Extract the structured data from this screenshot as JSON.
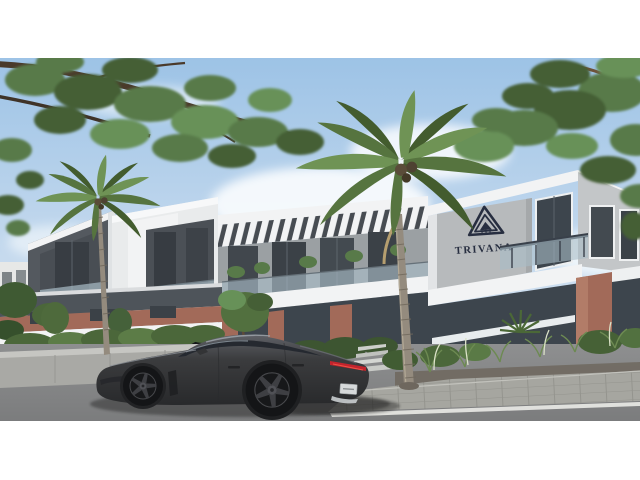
{
  "meta": {
    "kind": "architectural-exterior-render",
    "description": "Modern two-storey TRIVANA mixed-use complex with grey panel upper floor, white fascias, glass balconies and brick ground-floor accents; coconut palms and overhanging branches frame a blue sky; a dark grey fastback sedan passes on the road in the foreground; white letterbox bands top and bottom"
  },
  "branding": {
    "name": "TRIVANA",
    "logo_mark": "nested-triangle-monogram"
  },
  "vehicle": {
    "type": "dark-grey-fastback-sedan",
    "view": "rear-three-quarter-facing-left",
    "tail_light": "full-width-red-bar",
    "license_plate_visible": true
  },
  "palette": {
    "letterbox": "#ffffff",
    "sky_top": "#9dc3e6",
    "sky_mid": "#c6daee",
    "sky_horizon": "#e9f1f7",
    "cloud": "#fbfdfe",
    "panel_dark": "#54595f",
    "panel_darker": "#474c52",
    "fascia": "#f2f3f4",
    "sign_wall": "#b7babc",
    "logo": "#272e40",
    "brick": "#a26a59",
    "glass_dark": "#3d454d",
    "balustrade": "#a9bcc6",
    "awning": "#e8ecee",
    "road": "#8e8f90",
    "road_low": "#7b7c7d",
    "marking": "#e6e6e2",
    "sidewalk": "#a6a6a0",
    "wall_gray": "#a9a9a5",
    "foliage": "#587a49",
    "foliage_dark": "#455f36",
    "foliage_light": "#679158",
    "frond": "#56743f",
    "frond_dark": "#435c2e",
    "frond_light": "#6f9355",
    "trunk": "#948b7e",
    "branch_left": "#4a3a2b",
    "branch_right": "#7c5d41",
    "car_body": "#3b3c3e",
    "car_glass": "#252930",
    "tail_red": "#c3242d",
    "rim": "#3e3f43",
    "plate": "#d6d9da",
    "shrub": "#4b673a",
    "grass": "#6d8a52",
    "plume": "#dbe2c8",
    "soil": "#6e675e",
    "steps": "#c9cbc7",
    "hedge": "#3d5531"
  }
}
